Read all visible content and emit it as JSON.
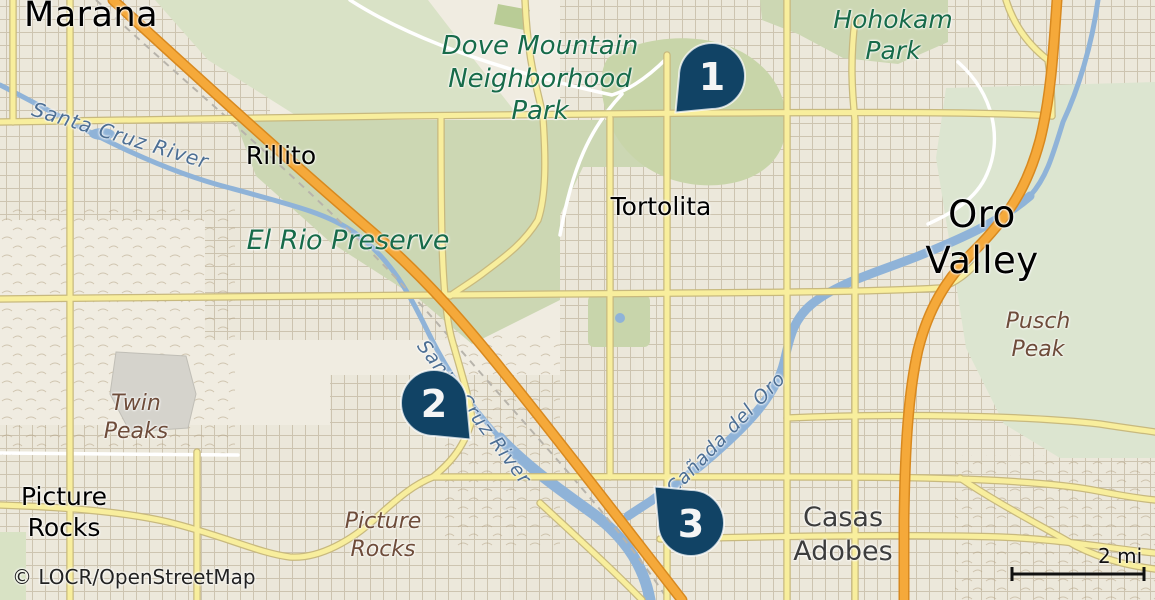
{
  "attribution": "© LOCR/OpenStreetMap",
  "scale_bar": {
    "label": "2 mi"
  },
  "pins": [
    {
      "number": "1"
    },
    {
      "number": "2"
    },
    {
      "number": "3"
    }
  ],
  "labels": {
    "marana": "Marana",
    "oro_valley": "Oro Valley",
    "rillito": "Rillito",
    "tortolita": "Tortolita",
    "picture_rocks_town": "Picture\nRocks",
    "casas_adobes": "Casas\nAdobes",
    "dove_mountain_park": "Dove Mountain\nNeighborhood\nPark",
    "hohokam_park": "Hohokam\nPark",
    "el_rio_preserve": "El Rio Preserve",
    "twin_peaks": "Twin\nPeaks",
    "pusch_peak": "Pusch\nPeak",
    "picture_rocks_locale": "Picture\nRocks",
    "santa_cruz_river_nw": "Santa Cruz River",
    "santa_cruz_river_mid": "Santa Cruz River",
    "canada_del_oro": "Cañada del Oro"
  },
  "colors": {
    "land": "#f0ece1",
    "urban_block": "#ebe7da",
    "park_green": "#ccd7b3",
    "pale_green": "#dce5d0",
    "water": "#8fb3d8",
    "road_yellow": "#f8ee9d",
    "road_yellow_casing": "#c8b97e",
    "highway_orange": "#f5a93a",
    "highway_orange_casing": "#d8891f",
    "pin_navy": "#114365",
    "pin_number": "#f5f5f5",
    "label_park_green": "#176b4a",
    "label_water_blue": "#4d6f94",
    "label_terrain_brown": "#6e4c3a"
  }
}
